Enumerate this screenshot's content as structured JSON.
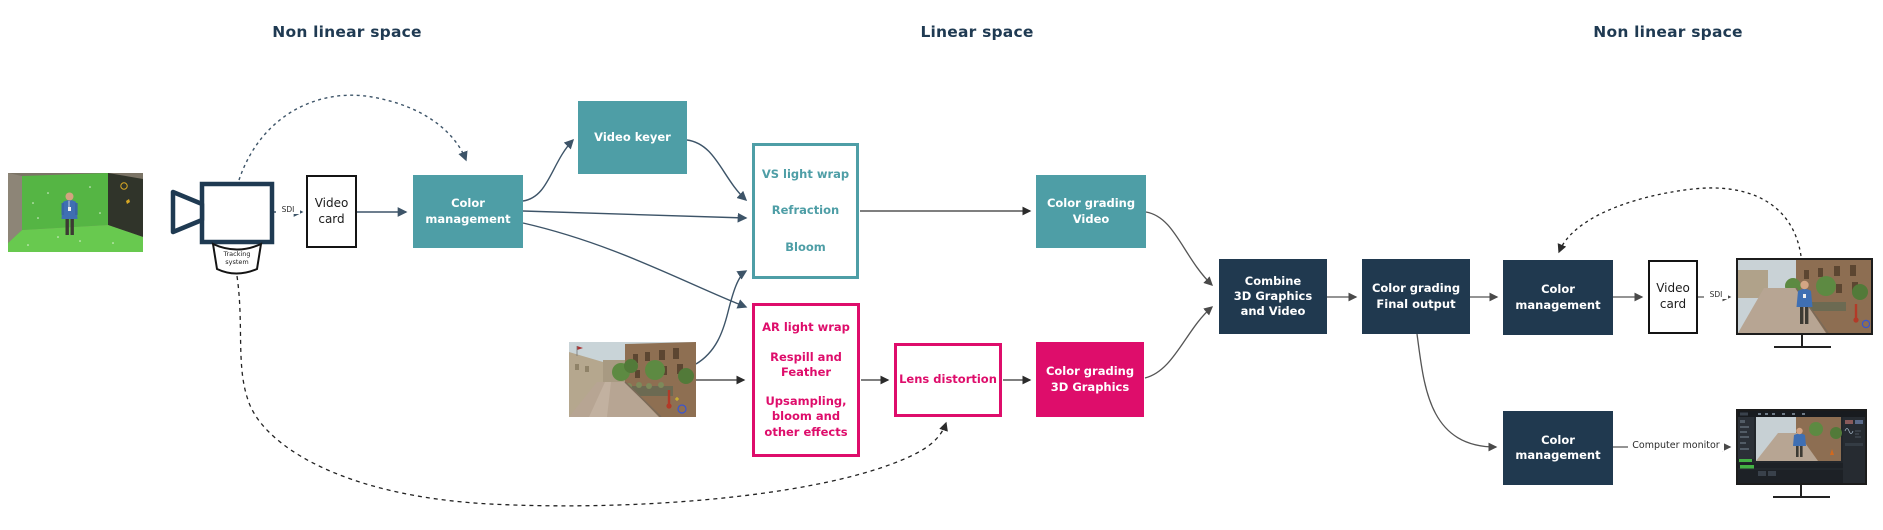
{
  "headings": {
    "left": "Non linear space",
    "center": "Linear space",
    "right": "Non linear space"
  },
  "colors": {
    "teal": "#4E9EA6",
    "pink": "#DE0D6B",
    "navy": "#20394F",
    "heading": "#1F3A52"
  },
  "connector_labels": {
    "sdi_in": "SDI",
    "sdi_out": "SDI",
    "computer_monitor": "Computer monitor"
  },
  "nodes": {
    "tracking_system": {
      "lines": [
        "Tracking",
        "system"
      ]
    },
    "video_card_in": {
      "lines": [
        "Video",
        "card"
      ]
    },
    "color_management_in": {
      "lines": [
        "Color",
        "management"
      ]
    },
    "video_keyer": {
      "lines": [
        "Video keyer"
      ]
    },
    "vs_effects": {
      "items": [
        [
          "VS light wrap"
        ],
        [
          "Refraction"
        ],
        [
          "Bloom"
        ]
      ]
    },
    "ar_effects": {
      "items": [
        [
          "AR light wrap"
        ],
        [
          "Respill and",
          "Feather"
        ],
        [
          "Upsampling,",
          "bloom and",
          "other effects"
        ]
      ]
    },
    "lens_distortion": {
      "lines": [
        "Lens distortion"
      ]
    },
    "color_grading_video": {
      "lines": [
        "Color grading",
        "Video"
      ]
    },
    "color_grading_3d": {
      "lines": [
        "Color grading",
        "3D Graphics"
      ]
    },
    "combine": {
      "lines": [
        "Combine",
        "3D Graphics",
        "and Video"
      ]
    },
    "color_grading_final": {
      "lines": [
        "Color grading",
        "Final output"
      ]
    },
    "color_management_out": {
      "lines": [
        "Color",
        "management"
      ]
    },
    "video_card_out": {
      "lines": [
        "Video",
        "card"
      ]
    },
    "color_management_monitor": {
      "lines": [
        "Color",
        "management"
      ]
    }
  },
  "images": {
    "greenscreen_photo": "camera-greenscreen-studio",
    "render_photo": "3d-render-street-scene",
    "monitor_top": "sdi-monitor-final-composite",
    "monitor_bottom": "computer-monitor-grading-software"
  }
}
